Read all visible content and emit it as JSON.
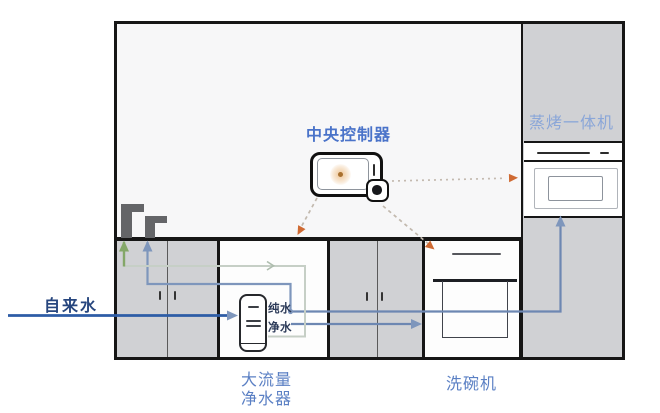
{
  "diagram": {
    "labels": {
      "central_controller": "中央控制器",
      "steam_oven": "蒸烤一体机",
      "tap_water": "自来水",
      "purifier_line1": "大流量",
      "purifier_line2": "净水器",
      "dishwasher": "洗碗机",
      "pure_water": "纯水",
      "filtered_water": "净水"
    },
    "colors": {
      "label_blue": "#4a73c9",
      "label_periwinkle": "#8aa6d8",
      "label_navy": "#27467e",
      "label_purifier_blue": "#5b80c4",
      "small_label_navy": "#2c3a58",
      "tap_line_navy": "#2d5ca6",
      "water_line_steel": "#7e96bc",
      "pure_line_steel": "#6d87b2",
      "green_line": "#84a768",
      "pale_green_line": "#c6cfc6",
      "orange_accent": "#cf6a33",
      "cabinet_gray": "#d0d1d4",
      "wall_bg": "#f7f7f8",
      "outline_black": "#161616"
    }
  }
}
